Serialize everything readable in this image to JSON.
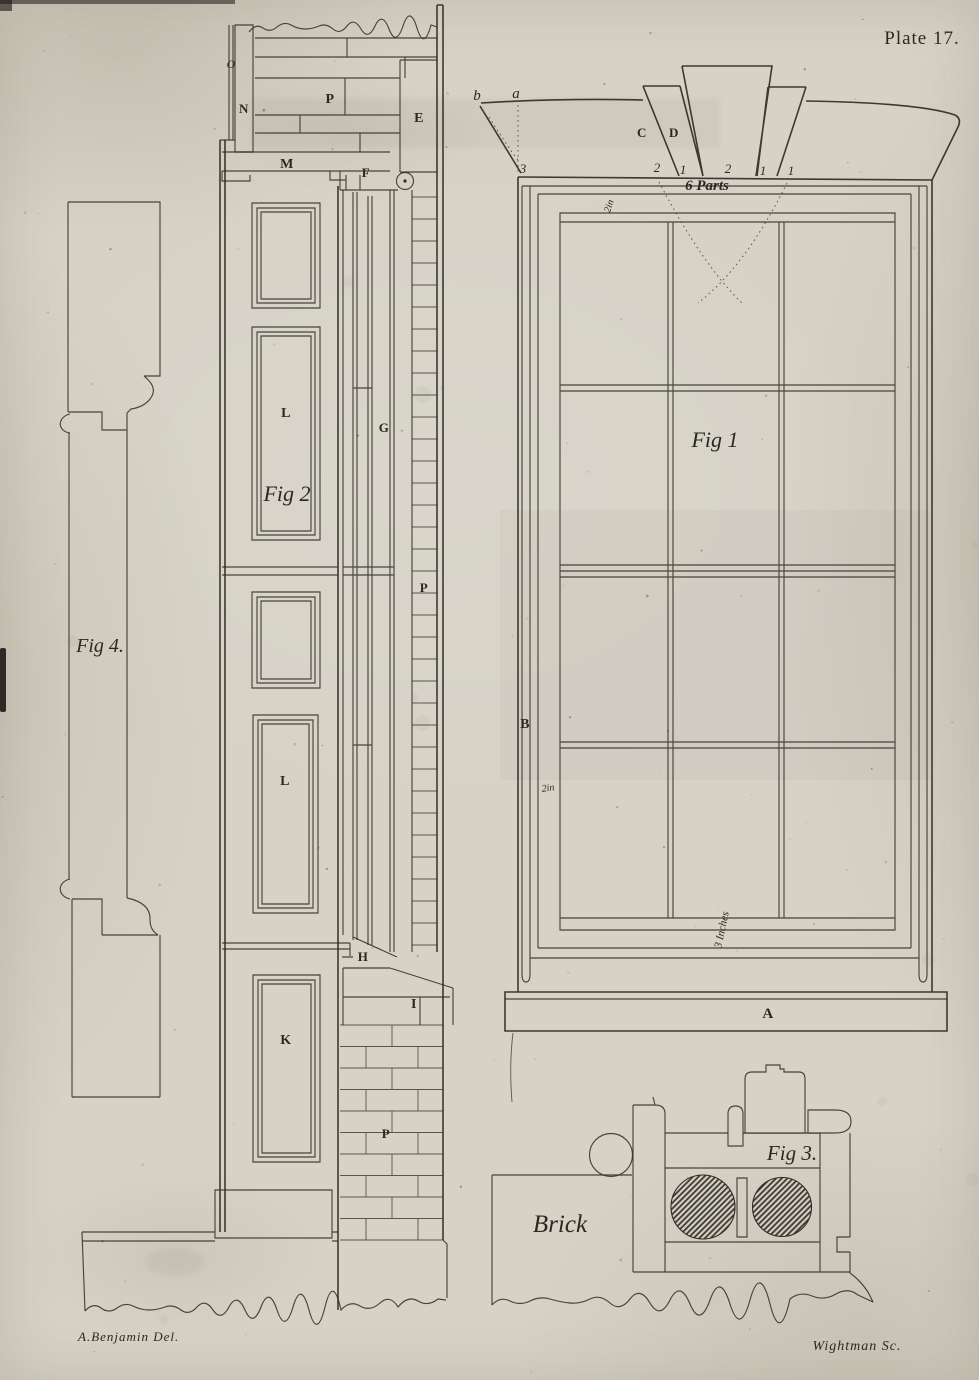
{
  "page": {
    "plate_label": "Plate 17.",
    "credit_delineator": "A.Benjamin Del.",
    "credit_engraver": "Wightman Sc.",
    "paper_color": "#d6d2c6",
    "ink_color": "#2e2b25"
  },
  "fig1": {
    "caption": "Fig 1",
    "arch": {
      "point_b": "b",
      "point_a": "a",
      "voussoir_c": "C",
      "voussoir_d": "D",
      "divisions": [
        "3",
        "2",
        "1",
        "2",
        "1",
        "1"
      ],
      "parts_label": "6 Parts"
    },
    "labels": {
      "jamb": "B",
      "sill": "A",
      "top_rail_width": "2in",
      "stile_width": "2in",
      "sill_depth": "3 Inches"
    }
  },
  "fig2": {
    "caption": "Fig 2",
    "labels": {
      "o": "O",
      "n": "N",
      "p_planks": "P",
      "e": "E",
      "m": "M",
      "f": "F",
      "l_upper": "L",
      "g": "G",
      "p_wall": "P",
      "l_lower": "L",
      "h": "H",
      "k": "K",
      "i": "I",
      "p_brick": "P"
    }
  },
  "fig3": {
    "caption": "Fig 3.",
    "brick_label": "Brick"
  },
  "fig4": {
    "caption": "Fig 4."
  }
}
